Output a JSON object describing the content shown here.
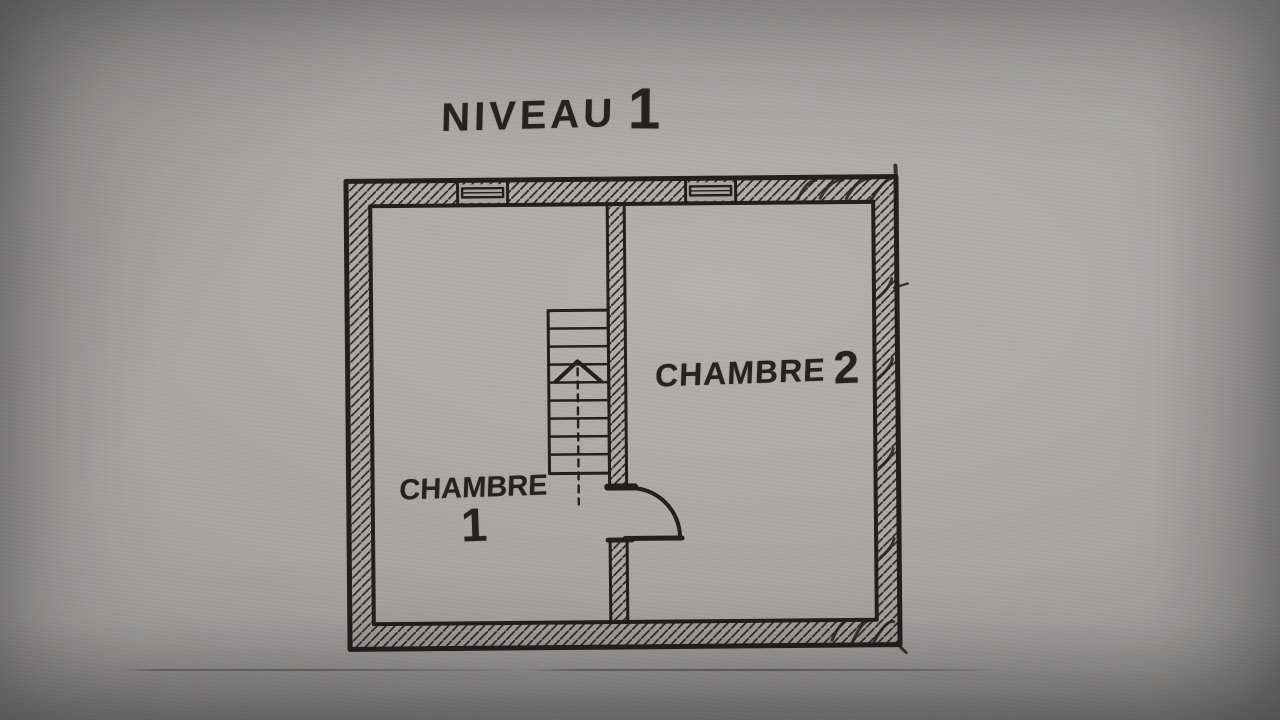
{
  "page": {
    "title": {
      "full": "NIVEAU 1",
      "word": "NIVEAU",
      "number": "1"
    }
  },
  "floorplan": {
    "rooms": [
      {
        "full": "CHAMBRE 1",
        "word": "CHAMBRE",
        "number": "1"
      },
      {
        "full": "CHAMBRE 2",
        "word": "CHAMBRE",
        "number": "2"
      }
    ],
    "staircase": {
      "steps": 10,
      "direction_arrow": "up"
    },
    "windows_count": 2,
    "doors_count": 1,
    "colors": {
      "ink": "#23201e",
      "paper": "#a8a6a4"
    }
  }
}
